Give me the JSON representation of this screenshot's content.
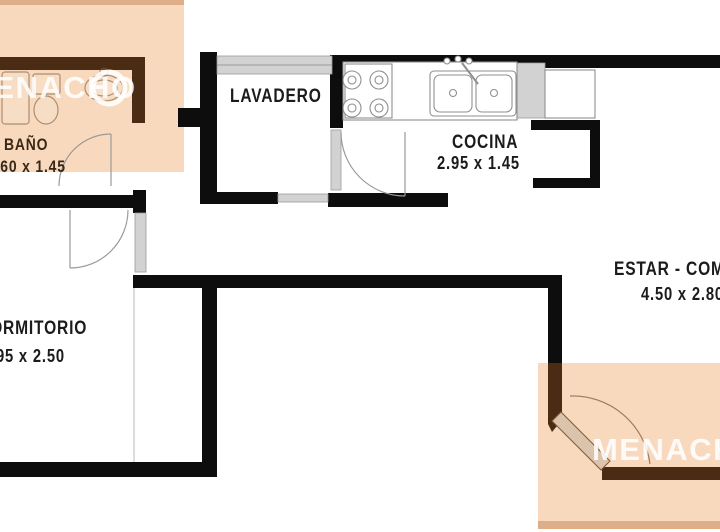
{
  "brand": {
    "name": "MENACHO"
  },
  "rooms": {
    "bano": {
      "label": "BAÑO",
      "dims": "1.60 x 1.45"
    },
    "lavadero": {
      "label": "LAVADERO"
    },
    "cocina": {
      "label": "COCINA",
      "dims": "2.95 x 1.45"
    },
    "dormitorio": {
      "label": "DORMITORIO",
      "dims": "2.95 x 2.50"
    },
    "estar": {
      "label": "ESTAR - COMEDOR",
      "dims": "4.50 x 2.80"
    }
  },
  "colors": {
    "wall": "#0d0d0d",
    "tint": "#4a2c15",
    "peach": "#f8d9bd",
    "edge": "#ddae88",
    "gray": "#d2d2d2",
    "leaf": "#dcc3ab",
    "ink": "#1b1b1b",
    "wmtext": "#ffffff"
  }
}
